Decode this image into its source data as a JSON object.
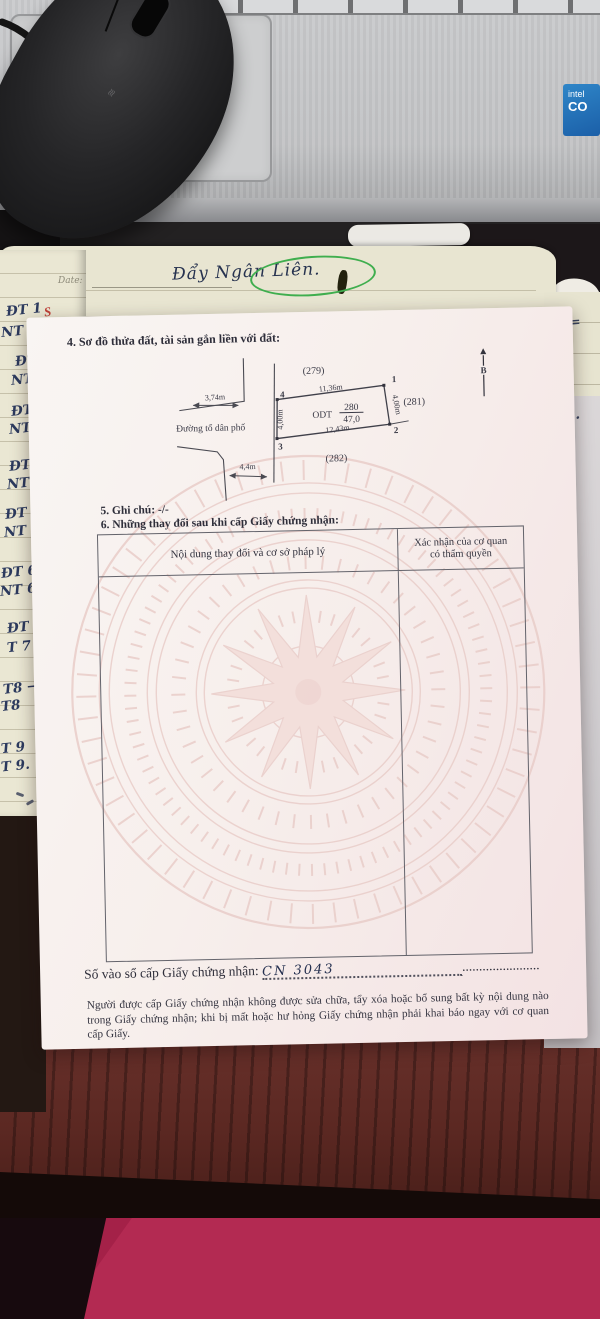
{
  "scene": {
    "laptop": {
      "intel_line1": "intel",
      "intel_line2": "CO"
    },
    "notebook_top": {
      "date_label": "Date:",
      "handwriting": "Đẩy Ngân Liên."
    },
    "notebook_left": {
      "accent": "S",
      "entries": [
        "ĐT 1",
        "NT 1 (→",
        "ĐT 2",
        "NT 2",
        "ĐT 3",
        "NT 3",
        "ĐT 4",
        "NT 4",
        "ĐT 5",
        "NT 5",
        "ĐT 6",
        "NT 6",
        "ĐT 7",
        "T 7",
        "T8 →",
        "T8",
        "T 9",
        "T 9."
      ]
    },
    "notebook_right": {
      "lines": [
        "lã =",
        "=",
        "270."
      ]
    }
  },
  "document": {
    "section4_title": "4. Sơ đồ thửa đất, tài sản gắn liền với đất:",
    "diagram": {
      "adjacent_top": "(279)",
      "adjacent_right": "(281)",
      "adjacent_bottom": "(282)",
      "road_label": "Đường tổ dân phố",
      "north_label": "B",
      "corner_1": "1",
      "corner_2": "2",
      "corner_3": "3",
      "corner_4": "4",
      "dim_offset": "3,74m",
      "dim_top": "11,36m",
      "dim_left": "4,00m",
      "dim_right": "4,00m",
      "dim_bottom": "12,43m",
      "dim_road": "4,4m",
      "land_use": "ODT",
      "parcel_number": "280",
      "parcel_area": "47,0"
    },
    "section5": "5. Ghi chú: -/-",
    "section6": "6. Những thay đổi sau khi cấp Giấy chứng nhận:",
    "table": {
      "col1_header": "Nội dung thay đổi và cơ sở pháp lý",
      "col2_header_line1": "Xác nhận của cơ quan",
      "col2_header_line2": "có thẩm quyền"
    },
    "registry": {
      "label": "Số vào sổ cấp Giấy chứng nhận:",
      "value": "CN  3043",
      "trailing_dots": "......................."
    },
    "footer": "Người được cấp Giấy chứng nhận không được sửa chữa, tẩy xóa hoặc bổ sung bất kỳ nội dung nào trong Giấy chứng nhận; khi bị mất hoặc hư hỏng Giấy chứng nhận phải khai báo ngay với cơ quan cấp Giấy."
  },
  "colors": {
    "watermark_pink": "#e9cdc9",
    "highlight_green": "#3fae4e",
    "fabric_red": "#a42148",
    "desk_wood": "#5b2822"
  }
}
